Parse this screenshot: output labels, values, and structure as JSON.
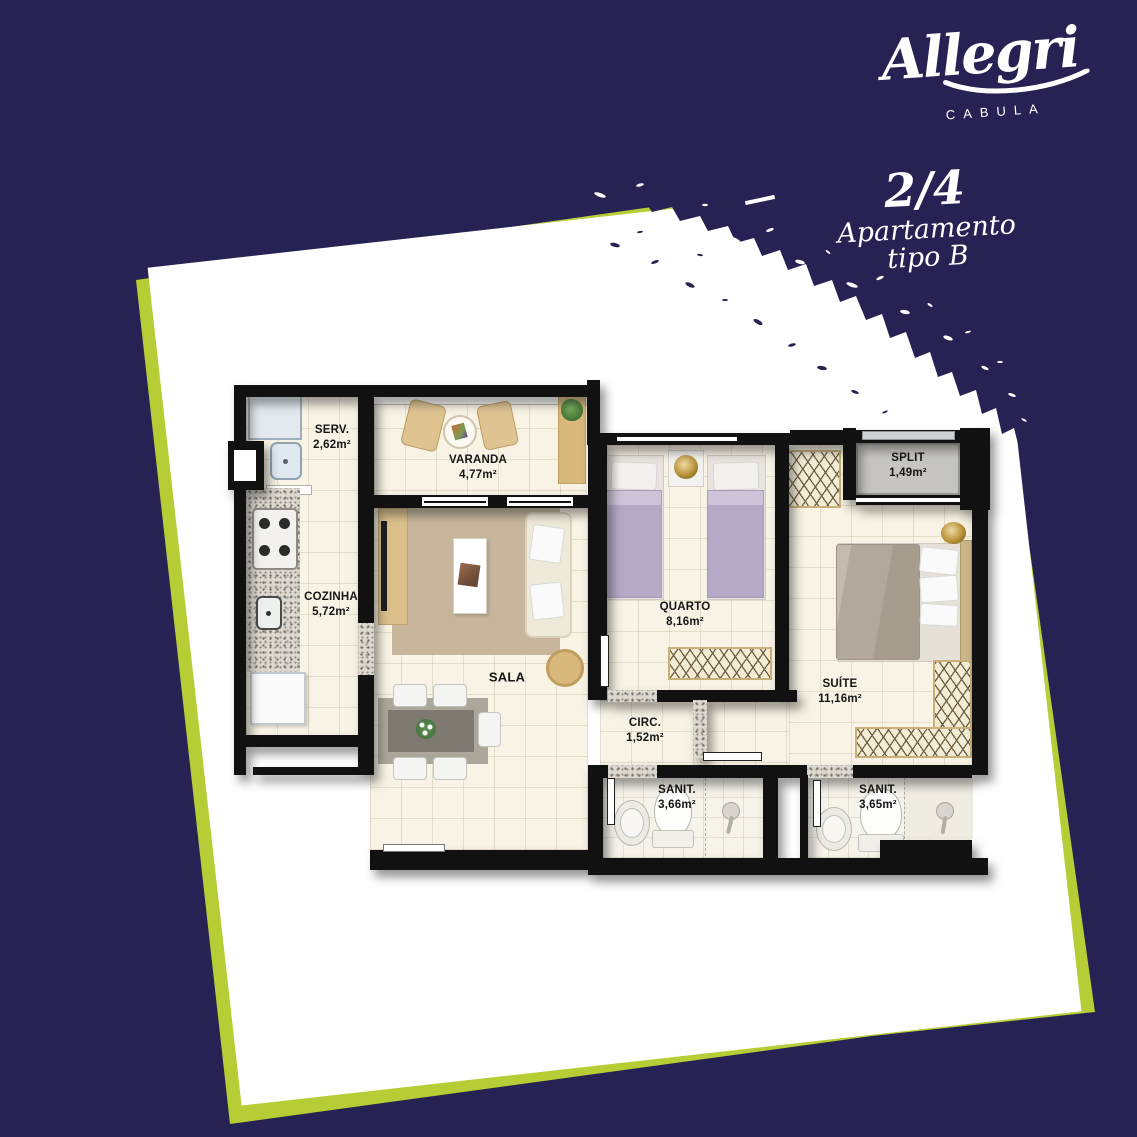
{
  "brand": {
    "name": "Allegri",
    "location": "CABULA"
  },
  "unit": {
    "type": "2/4",
    "kind": "Apartamento",
    "variant": "tipo B"
  },
  "rooms": {
    "serv": {
      "label": "SERV.",
      "area": "2,62m²"
    },
    "varanda": {
      "label": "VARANDA",
      "area": "4,77m²"
    },
    "cozinha": {
      "label": "COZINHA",
      "area": "5,72m²"
    },
    "sala": {
      "label": "SALA",
      "area": ""
    },
    "quarto": {
      "label": "QUARTO",
      "area": "8,16m²"
    },
    "split": {
      "label": "SPLIT",
      "area": "1,49m²"
    },
    "suite": {
      "label": "SUÍTE",
      "area": "11,16m²"
    },
    "circ": {
      "label": "CIRC.",
      "area": "1,52m²"
    },
    "sanit1": {
      "label": "SANIT.",
      "area": "3,66m²"
    },
    "sanit2": {
      "label": "SANIT.",
      "area": "3,65m²"
    }
  },
  "colors": {
    "background": "#262253",
    "accent": "#b7cd35",
    "card": "#ffffff",
    "wall": "#111111",
    "floor": "#f8f3e4"
  }
}
